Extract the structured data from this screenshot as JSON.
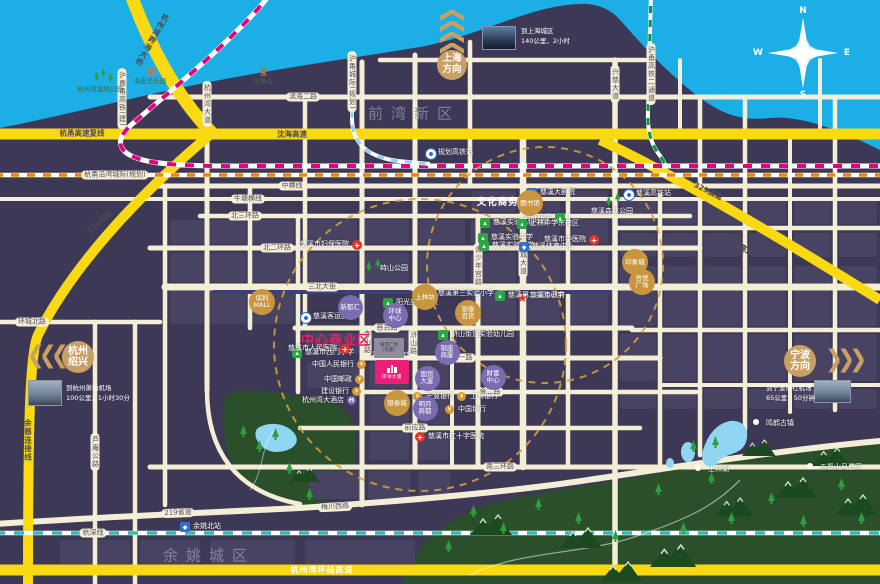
{
  "colors": {
    "water": "#1bafe6",
    "land": "#3e3857",
    "road_cream": "#f4eed6",
    "highway_yellow": "#f8d912",
    "rail_magenta": "#e6007e",
    "rail_orange": "#f08300",
    "rail_teal": "#39b8b2",
    "rail_green": "#019a44",
    "rail_lightblue": "#8ed2f2",
    "accent_gold": "#c9a063",
    "zone_magenta": "#ea1f63",
    "park_green": "#2a4f2a"
  },
  "compass": {
    "n": "N",
    "s": "S",
    "e": "E",
    "w": "W"
  },
  "directions": {
    "shanghai": {
      "line1": "上海",
      "line2": "方向"
    },
    "hangzhou": {
      "line1": "杭州",
      "line2": "绍兴"
    },
    "ningbo": {
      "line1": "宁波",
      "line2": "方向"
    }
  },
  "info_cards": {
    "shanghai": {
      "l1": "到上海城区",
      "l2": "140公里，2小时"
    },
    "hangzhou": {
      "l1": "到杭州萧山机场",
      "l2": "100公里，1小时30分"
    },
    "ningbo": {
      "l1": "到宁波栎社机场",
      "l2": "65公里，50分钟"
    }
  },
  "project": {
    "name": "环球大厦",
    "sale": "1号7号9号楼在售"
  },
  "construction_block": {
    "l1": "城市广场",
    "l2": "(在建)"
  },
  "labels": [
    {
      "t": "滨海二路",
      "x": 303,
      "y": 97,
      "c": "pill"
    },
    {
      "t": "中横线",
      "x": 292,
      "y": 186,
      "c": "pill"
    },
    {
      "t": "牛塘横线",
      "x": 248,
      "y": 199,
      "c": "pill"
    },
    {
      "t": "北三环路",
      "x": 245,
      "y": 216,
      "c": "pill"
    },
    {
      "t": "北二环路",
      "x": 277,
      "y": 248,
      "c": "pill"
    },
    {
      "t": "三北大街",
      "x": 322,
      "y": 287,
      "c": "pill"
    },
    {
      "t": "环城北路",
      "x": 32,
      "y": 322,
      "c": "pill"
    },
    {
      "t": "慈百路",
      "x": 387,
      "y": 328,
      "c": "pill"
    },
    {
      "t": "金一路",
      "x": 462,
      "y": 358,
      "c": "pill"
    },
    {
      "t": "金二路",
      "x": 490,
      "y": 392,
      "c": "pill"
    },
    {
      "t": "前应路",
      "x": 415,
      "y": 428,
      "c": "pill"
    },
    {
      "t": "南三环路",
      "x": 500,
      "y": 467,
      "c": "pill"
    },
    {
      "t": "梅川西路",
      "x": 335,
      "y": 507,
      "c": "pill",
      "r": -3
    },
    {
      "t": "219省道",
      "x": 178,
      "y": 513,
      "c": "pill",
      "r": -2
    },
    {
      "t": "杭深线",
      "x": 93,
      "y": 533,
      "c": "pill"
    },
    {
      "t": "杭甬沿湾城际(规划)",
      "x": 115,
      "y": 175,
      "c": "pill"
    },
    {
      "t": "杭州湾大道",
      "x": 207,
      "y": 104,
      "c": "vpill"
    },
    {
      "t": "兴慈大道",
      "x": 615,
      "y": 84,
      "c": "vpill"
    },
    {
      "t": "新城大道",
      "x": 523,
      "y": 259,
      "c": "vpill"
    },
    {
      "t": "青少年宫路",
      "x": 478,
      "y": 266,
      "c": "vpill"
    },
    {
      "t": "浒山路",
      "x": 413,
      "y": 343,
      "c": "vpill"
    },
    {
      "t": "寺山路",
      "x": 367,
      "y": 342,
      "c": "vpill"
    },
    {
      "t": "芦庵公路",
      "x": 95,
      "y": 452,
      "c": "vpill"
    },
    {
      "t": "沪嘉甬高铁(建)",
      "x": 122,
      "y": 99,
      "c": "vpill"
    },
    {
      "t": "沪甬城际(规划)",
      "x": 352,
      "y": 82,
      "c": "vpill"
    },
    {
      "t": "沪甬高铁二通道",
      "x": 651,
      "y": 74,
      "c": "vpill"
    },
    {
      "t": "杭甬高速复线",
      "x": 82,
      "y": 133,
      "c": "yel"
    },
    {
      "t": "沈海高速",
      "x": 292,
      "y": 134,
      "c": "yel"
    },
    {
      "t": "329国道",
      "x": 100,
      "y": 222,
      "c": "yel",
      "r": -42
    },
    {
      "t": "329国道",
      "x": 708,
      "y": 191,
      "c": "yel",
      "r": 26
    },
    {
      "t": "沈海高速",
      "x": 740,
      "y": 246,
      "c": "yel",
      "r": 33
    },
    {
      "t": "余慈连接线",
      "x": 28,
      "y": 440,
      "c": "yelv"
    },
    {
      "t": "杭州湾跨海大桥",
      "x": 152,
      "y": 40,
      "c": "yelv",
      "r": 30
    },
    {
      "t": "杭州湾环线高速",
      "x": 322,
      "y": 570,
      "c": "yelw"
    },
    {
      "t": "前湾新区",
      "x": 414,
      "y": 113,
      "c": "dist"
    },
    {
      "t": "余姚城区",
      "x": 209,
      "y": 555,
      "c": "dist"
    },
    {
      "t": "文化商务区",
      "x": 503,
      "y": 201,
      "c": "zonew"
    },
    {
      "t": "中心商业区",
      "x": 336,
      "y": 339,
      "c": "zonem"
    }
  ],
  "pois": [
    {
      "t": "慈溪实验高级中学",
      "x": 485,
      "y": 223,
      "k": "school"
    },
    {
      "t": "育才中学",
      "x": 560,
      "y": 218,
      "k": "school",
      "s": "l"
    },
    {
      "t": "上林中学东校区",
      "x": 522,
      "y": 224,
      "k": "school"
    },
    {
      "t": "慈溪实验中学",
      "x": 483,
      "y": 238,
      "k": "school"
    },
    {
      "t": "慈溪实验小学",
      "x": 484,
      "y": 246,
      "k": "school"
    },
    {
      "t": "阳光实验学校",
      "x": 388,
      "y": 303,
      "k": "school"
    },
    {
      "t": "慈溪第三实验小学",
      "x": 430,
      "y": 294,
      "k": "school"
    },
    {
      "t": "慈溪第二实验小学",
      "x": 500,
      "y": 296,
      "k": "school"
    },
    {
      "t": "慈溪市西门小学",
      "x": 297,
      "y": 353,
      "k": "school"
    },
    {
      "t": "浒山街道实验幼儿园",
      "x": 443,
      "y": 335,
      "k": "school"
    },
    {
      "t": "慈溪市中医院",
      "x": 594,
      "y": 240,
      "k": "hosp",
      "s": "l"
    },
    {
      "t": "慈溪市妇保医院",
      "x": 357,
      "y": 245,
      "k": "hosp",
      "s": "l"
    },
    {
      "t": "慈溪市人民医院",
      "x": 345,
      "y": 349,
      "k": "hosp",
      "s": "l"
    },
    {
      "t": "慈溪市红十字医院",
      "x": 420,
      "y": 437,
      "k": "hosp"
    },
    {
      "t": "慈溪大剧院",
      "x": 532,
      "y": 193,
      "k": "civic"
    },
    {
      "t": "慈溪体育中心",
      "x": 524,
      "y": 247,
      "k": "civic"
    },
    {
      "t": "余姚北站",
      "x": 185,
      "y": 527,
      "k": "civic"
    },
    {
      "t": "慈溪客运西站",
      "x": 305,
      "y": 317,
      "k": "transit"
    },
    {
      "t": "慈溪高铁站",
      "x": 628,
      "y": 194,
      "k": "transit"
    },
    {
      "t": "规划高铁站",
      "x": 430,
      "y": 153,
      "k": "transit"
    },
    {
      "t": "慈溪市政府",
      "x": 522,
      "y": 296,
      "k": "gov"
    },
    {
      "t": "中国人民银行",
      "x": 362,
      "y": 365,
      "k": "bank",
      "s": "l"
    },
    {
      "t": "中国邮政",
      "x": 360,
      "y": 380,
      "k": "bank",
      "s": "l"
    },
    {
      "t": "建设银行",
      "x": 357,
      "y": 392,
      "k": "bank",
      "s": "l"
    },
    {
      "t": "杭州湾大酒店",
      "x": 352,
      "y": 401,
      "k": "hotel",
      "s": "l"
    },
    {
      "t": "宁波银行",
      "x": 418,
      "y": 397,
      "k": "bank"
    },
    {
      "t": "工商银行",
      "x": 462,
      "y": 397,
      "k": "bank"
    },
    {
      "t": "中国银行",
      "x": 450,
      "y": 410,
      "k": "bank"
    },
    {
      "t": "峙山公园",
      "x": 372,
      "y": 269,
      "k": "trees"
    },
    {
      "t": "慈溪森林公园",
      "x": 612,
      "y": 200,
      "k": "trees",
      "s": "b"
    },
    {
      "t": "杭州湾湿地公园",
      "x": 100,
      "y": 78,
      "k": "trees",
      "s": "b",
      "dk": 1
    },
    {
      "t": "海皮岛乐园",
      "x": 150,
      "y": 70,
      "k": "ferris",
      "s": "b",
      "dk": 1
    },
    {
      "t": "达蓬山",
      "x": 263,
      "y": 70,
      "k": "castle",
      "s": "b",
      "dk": 1
    },
    {
      "t": "上林湖",
      "x": 700,
      "y": 470,
      "k": "dot"
    },
    {
      "t": "鸣鹤古镇",
      "x": 758,
      "y": 424,
      "k": "dot"
    },
    {
      "t": "五磊山风景区",
      "x": 812,
      "y": 468,
      "k": "dot"
    }
  ],
  "circle_pois": [
    {
      "x": 262,
      "y": 302,
      "k": "gold",
      "l": [
        "保利",
        "MALL"
      ]
    },
    {
      "x": 425,
      "y": 297,
      "k": "gold",
      "l": [
        "上林坊"
      ]
    },
    {
      "x": 468,
      "y": 313,
      "k": "gold",
      "l": [
        "银泰",
        "百货"
      ]
    },
    {
      "x": 530,
      "y": 203,
      "k": "gold",
      "l": [
        "图书馆"
      ]
    },
    {
      "x": 635,
      "y": 262,
      "k": "gold",
      "l": [
        "印象城"
      ]
    },
    {
      "x": 642,
      "y": 282,
      "k": "gold",
      "l": [
        "吾悦",
        "广场"
      ]
    },
    {
      "x": 397,
      "y": 403,
      "k": "gold",
      "l": [
        "银泰城"
      ]
    },
    {
      "x": 350,
      "y": 307,
      "k": "purple",
      "l": [
        "新都汇"
      ]
    },
    {
      "x": 395,
      "y": 315,
      "k": "purple",
      "l": [
        "环球",
        "中心"
      ]
    },
    {
      "x": 447,
      "y": 352,
      "k": "purple",
      "l": [
        "银座",
        "商厦"
      ]
    },
    {
      "x": 427,
      "y": 378,
      "k": "purple",
      "l": [
        "国贸",
        "大厦"
      ]
    },
    {
      "x": 493,
      "y": 377,
      "k": "purple",
      "l": [
        "财富",
        "中心"
      ]
    },
    {
      "x": 425,
      "y": 408,
      "k": "purple",
      "l": [
        "明月",
        "商都"
      ]
    }
  ]
}
